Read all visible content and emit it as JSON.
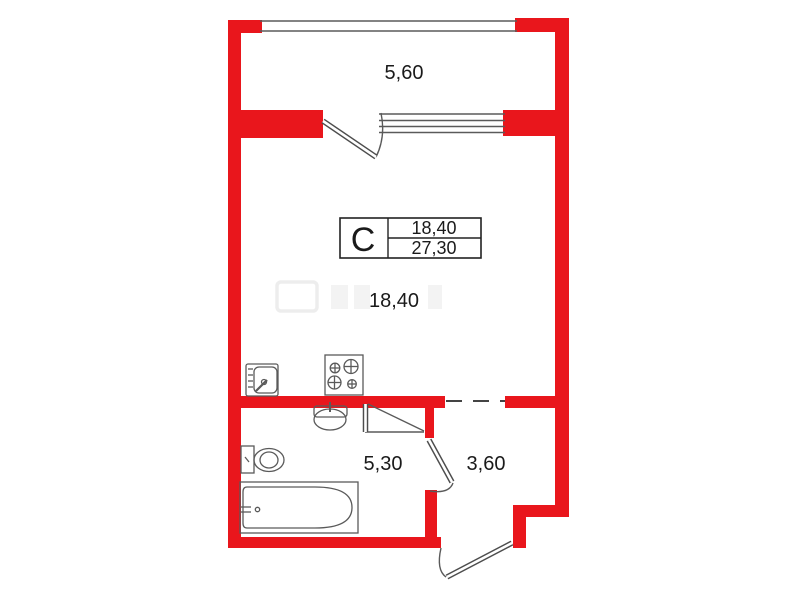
{
  "unit_table": {
    "type_label": "С",
    "living_area": "18,40",
    "total_area": "27,30"
  },
  "rooms": {
    "balcony_area": "5,60",
    "studio_area": "18,40",
    "bathroom_area": "5,30",
    "hall_area": "3,60"
  },
  "colors": {
    "wall_red": "#e9161c",
    "drawing_line_gray": "#5a5a5a",
    "text_black": "#1a1a1a"
  }
}
